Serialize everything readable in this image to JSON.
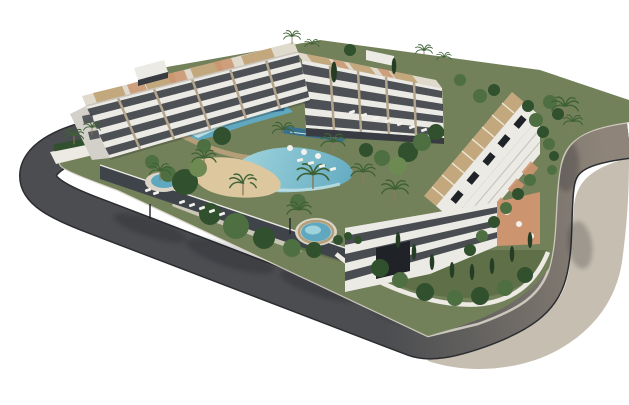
{
  "scene": {
    "label": "Aerial 3D architectural rendering of a white apartment complex with rooftop pergola terraces, central lagoon pool with sandy beach, round jacuzzi, palm trees and a curving perimeter road with sidewalk",
    "elements": [
      "perimeter-road",
      "sidewalk",
      "west-apartment-block",
      "north-apartment-block",
      "east-apartment-block",
      "corner-apartment-block",
      "upper-infinity-pool",
      "lagoon-pool",
      "beach-area",
      "jacuzzi-pool",
      "west-plunge-pool",
      "north-lap-pool",
      "garden-courtyard",
      "palm-trees",
      "cypress-trees",
      "sun-loungers",
      "perimeter-wall",
      "garage-entrance"
    ]
  },
  "colors": {
    "bg": "#ffffff",
    "asphalt": "#4b4d50",
    "asphalt_warm": "#8e8479",
    "curb": "#2b2d30",
    "curb_light": "#d7d1c5",
    "sidewalk": "#c6beb0",
    "lawn": "#73815a",
    "lawn_dark": "#5a6a42",
    "sand": "#dcc79f",
    "paving": "#d9d4c7",
    "facade": "#eceae4",
    "facade_shade": "#d2d0c9",
    "roof_light": "#e0dacd",
    "glass": "#383c42",
    "garage": "#1f2226",
    "pier": "#b3a58c",
    "pergola": "#c3a87e",
    "slat": "#efe8d6",
    "terrace": "#cc9570",
    "plinth": "#3f434a",
    "wall": "#eceae3",
    "rail": "#c9c6bf",
    "stone": "#b49e78",
    "pool_deep": "#2f6e96",
    "pool_mid": "#5fa8bf",
    "pool_light": "#9ed3dc",
    "pool_pale": "#c4e3e7",
    "tree_dark": "#31502e",
    "tree_mid": "#4e6f41",
    "tree_light": "#6d8a52",
    "cypress": "#243d24",
    "palm": "#3f6136",
    "trunk": "#8a7a5f",
    "lounger": "#f2f1ec",
    "shadow": "#16181c"
  }
}
